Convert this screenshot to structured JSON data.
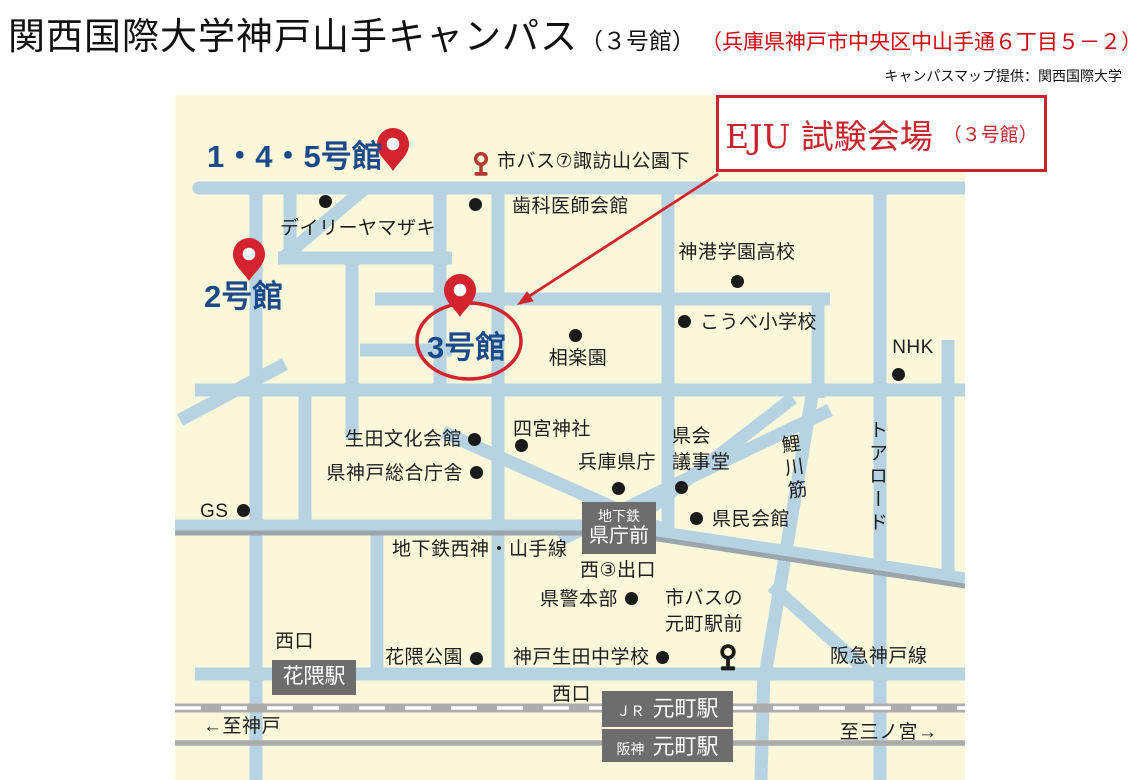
{
  "page": {
    "title_main": "関西国際大学神戸山手キャンパス",
    "title_sub": "（３号館）",
    "title_address": "（兵庫県神戸市中央区中山手通６丁目５－２）",
    "credit": "キャンパスマップ提供：関西国際大学"
  },
  "callout": {
    "label_main": "EJU 試験会場",
    "label_sub": "（３号館）"
  },
  "colors": {
    "map_bg": "#fbf7da",
    "road": "#b7d3e2",
    "railway": "#acacac",
    "red": "#d2232e",
    "navy": "#1b4a8b",
    "station_box": "#6d6d6d"
  },
  "map": {
    "buildings": [
      {
        "name": "label-building-145",
        "text": "1・4・5号館",
        "x": 207,
        "y": 131,
        "pin": {
          "x": 393,
          "y": 171
        }
      },
      {
        "name": "label-building-2",
        "text": "2号館",
        "x": 204,
        "y": 271,
        "pin": {
          "x": 249,
          "y": 281
        }
      },
      {
        "name": "label-building-3",
        "text": "3号館",
        "x": 427,
        "y": 322,
        "pin": {
          "x": 460,
          "y": 317
        }
      }
    ],
    "places": [
      {
        "name": "label-city-bus-suwayama",
        "text": "市バス⑦諏訪山公園下",
        "x": 497,
        "y": 149,
        "align": "left"
      },
      {
        "name": "label-dental-association-hall",
        "text": "歯科医師会館",
        "x": 512,
        "y": 194,
        "align": "left",
        "dot": {
          "x": 475,
          "y": 204
        }
      },
      {
        "name": "label-daily-yamazaki",
        "text": "デイリーヤマザキ",
        "x": 358,
        "y": 216,
        "align": "center",
        "dot": {
          "x": 325,
          "y": 201
        }
      },
      {
        "name": "label-shinko-gakuen-hs",
        "text": "神港学園高校",
        "x": 737,
        "y": 240,
        "align": "center",
        "dot": {
          "x": 737,
          "y": 281
        }
      },
      {
        "name": "label-kobe-elementary",
        "text": "こうべ小学校",
        "x": 700,
        "y": 310,
        "align": "left",
        "dot": {
          "x": 684,
          "y": 321
        }
      },
      {
        "name": "label-nhk",
        "text": "NHK",
        "x": 913,
        "y": 335,
        "align": "center",
        "dot": {
          "x": 898,
          "y": 374
        }
      },
      {
        "name": "label-sorakuen",
        "text": "相楽園",
        "x": 578,
        "y": 346,
        "align": "center",
        "dot": {
          "x": 575,
          "y": 335
        }
      },
      {
        "name": "label-shinomiya-shrine",
        "text": "四宮神社",
        "x": 513,
        "y": 417,
        "align": "left",
        "dot": {
          "x": 521,
          "y": 445
        }
      },
      {
        "name": "label-ikuta-culture-hall",
        "text": "生田文化会館",
        "x": 462,
        "y": 427,
        "align": "right",
        "dot": {
          "x": 474,
          "y": 439
        }
      },
      {
        "name": "label-pref-kobe-office",
        "text": "県神戸総合庁舎",
        "x": 463,
        "y": 461,
        "align": "right",
        "dot": {
          "x": 476,
          "y": 472
        }
      },
      {
        "name": "label-hyogo-pref-office",
        "text": "兵庫県庁",
        "x": 578,
        "y": 450,
        "align": "left",
        "dot": {
          "x": 618,
          "y": 488
        }
      },
      {
        "name": "label-pref-assembly-hall",
        "text": "県会\n議事堂",
        "x": 672,
        "y": 424,
        "align": "left",
        "dot": {
          "x": 681,
          "y": 487
        }
      },
      {
        "name": "label-kenmin-hall",
        "text": "県民会館",
        "x": 712,
        "y": 507,
        "align": "left",
        "dot": {
          "x": 696,
          "y": 518
        }
      },
      {
        "name": "label-gs",
        "text": "GS",
        "x": 200,
        "y": 499,
        "align": "left",
        "dot": {
          "x": 243,
          "y": 510
        }
      },
      {
        "name": "label-subway-seishin-yamate-line",
        "text": "地下鉄西神・山手線",
        "x": 392,
        "y": 537,
        "align": "left"
      },
      {
        "name": "label-west-exit-3",
        "text": "西③出口",
        "x": 580,
        "y": 558,
        "align": "left"
      },
      {
        "name": "label-pref-police-hq",
        "text": "県警本部",
        "x": 540,
        "y": 587,
        "align": "left",
        "dot": {
          "x": 631,
          "y": 598
        }
      },
      {
        "name": "label-city-bus-motomachi",
        "text": "市バスの\n元町駅前",
        "x": 704,
        "y": 586,
        "align": "center"
      },
      {
        "name": "label-hanakuma-park",
        "text": "花隈公園",
        "x": 385,
        "y": 645,
        "align": "left",
        "dot": {
          "x": 476,
          "y": 658
        }
      },
      {
        "name": "label-kobe-ikuta-jhs",
        "text": "神戸生田中学校",
        "x": 513,
        "y": 645,
        "align": "left",
        "dot": {
          "x": 662,
          "y": 657
        }
      },
      {
        "name": "label-west-exit-hanakuma",
        "text": "西口",
        "x": 275,
        "y": 629,
        "align": "left"
      },
      {
        "name": "label-west-exit-motomachi",
        "text": "西口",
        "x": 552,
        "y": 682,
        "align": "left"
      },
      {
        "name": "label-hankyu-kobe-line",
        "text": "阪急神戸線",
        "x": 830,
        "y": 644,
        "align": "left"
      },
      {
        "name": "label-to-sannomiya",
        "text": "至三ノ宮→",
        "x": 840,
        "y": 720,
        "align": "left"
      },
      {
        "name": "label-to-kobe",
        "text": "←至神戸",
        "x": 203,
        "y": 714,
        "align": "left"
      }
    ],
    "vertical_labels": [
      {
        "name": "label-koikawa-suji",
        "text": "鯉川筋",
        "x": 779,
        "y": 434,
        "rotate": -8
      },
      {
        "name": "label-tor-road",
        "text": "トアロード",
        "x": 863,
        "y": 420,
        "rotate": 0
      }
    ],
    "stations": [
      {
        "name": "station-box-kencho-mae",
        "x": 582,
        "y": 502,
        "w": 74,
        "h": 52,
        "layout": "col",
        "lines": [
          {
            "t": "地下鉄",
            "s": 14
          },
          {
            "t": "県庁前",
            "s": 20
          }
        ]
      },
      {
        "name": "station-box-hanakuma",
        "x": 272,
        "y": 660,
        "w": 84,
        "h": 35,
        "layout": "row",
        "lines": [
          {
            "t": "花隈駅",
            "s": 21
          }
        ]
      },
      {
        "name": "station-box-jr-motomachi",
        "x": 602,
        "y": 691,
        "w": 131,
        "h": 36,
        "layout": "row",
        "lines": [
          {
            "t": "ＪＲ",
            "s": 14
          },
          {
            "t": "元町駅",
            "s": 22
          }
        ]
      },
      {
        "name": "station-box-hanshin-motomachi",
        "x": 602,
        "y": 729,
        "w": 131,
        "h": 33,
        "layout": "row",
        "lines": [
          {
            "t": "阪神",
            "s": 14
          },
          {
            "t": "元町駅",
            "s": 22
          }
        ]
      }
    ],
    "bus_stops": [
      {
        "name": "bus-stop-icon-suwayama",
        "x": 481,
        "y": 170,
        "color": "#b2372e",
        "scale": 1
      },
      {
        "name": "bus-stop-icon-motomachi",
        "x": 728,
        "y": 664,
        "color": "#1a1a1a",
        "scale": 1.1
      }
    ]
  }
}
